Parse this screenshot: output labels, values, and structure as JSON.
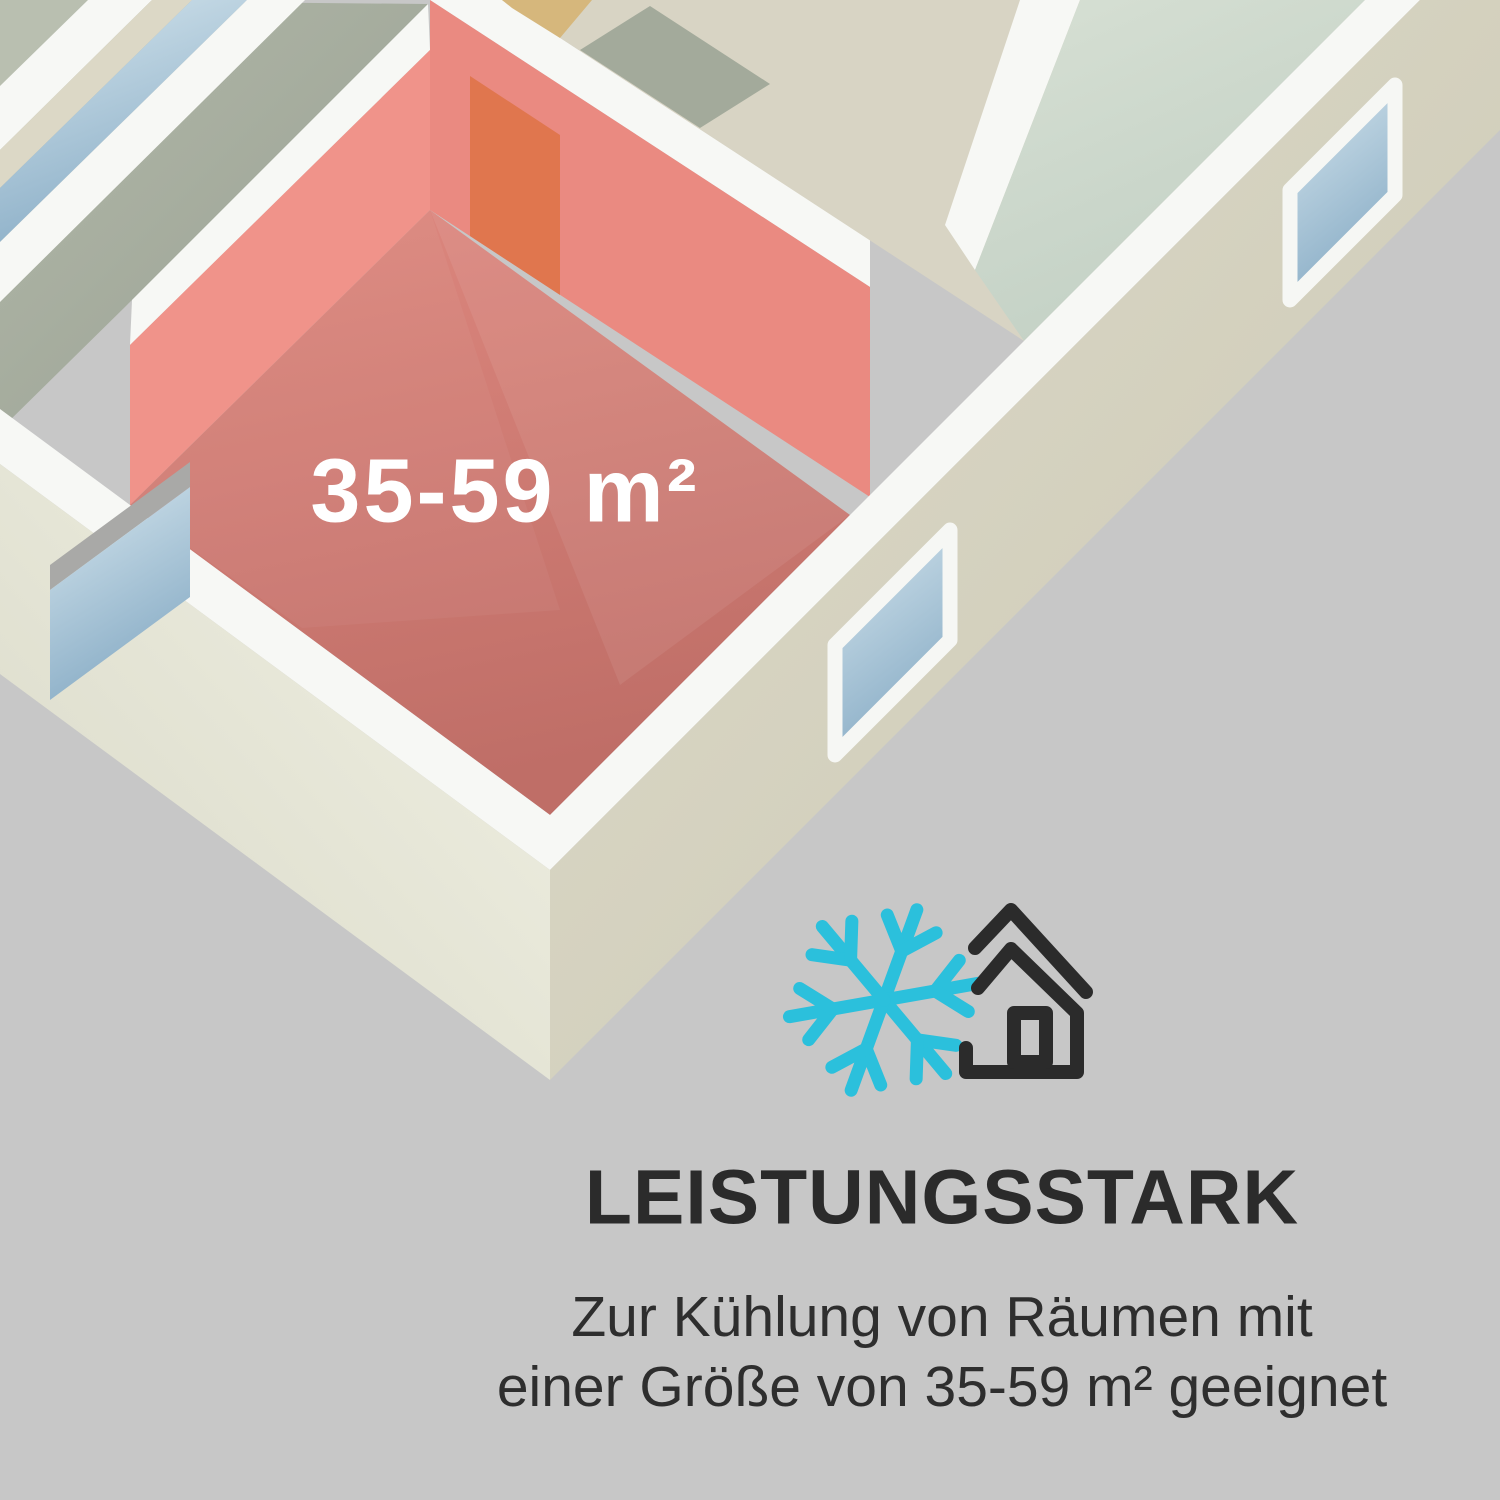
{
  "illustration": {
    "room_label": "35-59 m²",
    "description": "isometric-floorplan-with-highlighted-room"
  },
  "icons": {
    "snowflake": "snowflake-icon",
    "house": "house-cooling-icon"
  },
  "colors": {
    "background": "#c7c7c7",
    "accent_cyan": "#2bc0dc",
    "room_red": "#ca7970",
    "room_wall_red": "#ea8a81",
    "door_orange": "#e0764e",
    "wall_white": "#f7f8f5",
    "wall_cream": "#e9e9db",
    "text_dark": "#2b2b2b"
  },
  "headline": "LEISTUNGSSTARK",
  "subtext_line1": "Zur Kühlung von Räumen mit",
  "subtext_line2": "einer Größe von 35-59 m² geeignet"
}
